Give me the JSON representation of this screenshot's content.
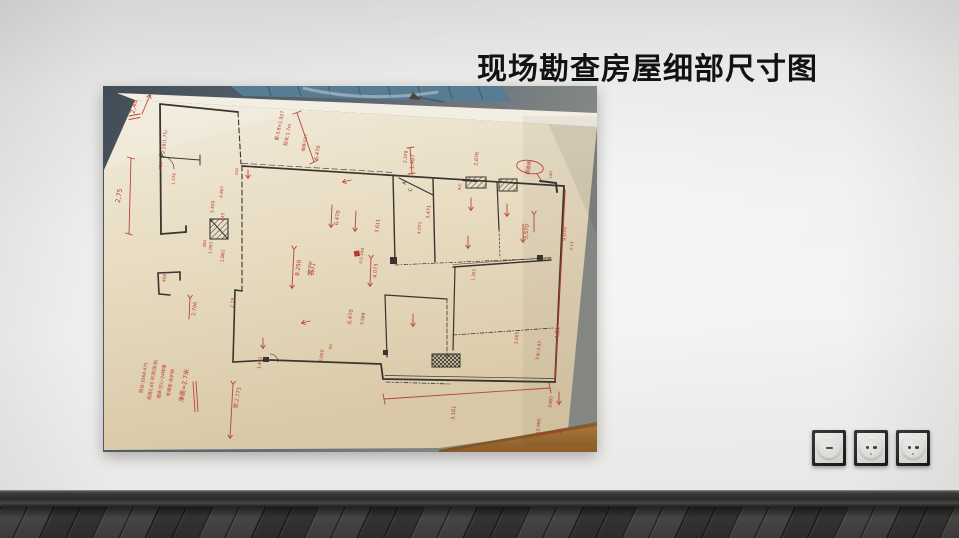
{
  "title": "现场勘查房屋细部尺寸图",
  "colors": {
    "ink_red": "#b23a2b",
    "ink_black": "#332e28",
    "paper": "#e9dfc6",
    "wall": "#ededec",
    "floor": "#3c3b3a",
    "table_blue": "#5a7c92",
    "baseboard": "#2b2b2a"
  },
  "photo": {
    "annotations": {
      "a1": "2,48",
      "a2": "2.18(1.75)",
      "a3": "450",
      "a4": "1.376",
      "a5": "2,75",
      "a6": "3.400",
      "a7": "445",
      "a8": "1.093",
      "a9": "1,861",
      "a10": "400",
      "a11": "2.706",
      "a12": "2,18",
      "a13": "窗:3.8×1.927",
      "a14": "延长:1.7m",
      "a15": "墙高:537",
      "a16": "6.470",
      "a17": "1,487",
      "a18": "2,876",
      "a19": "烟道阀",
      "a20": "6.470",
      "a21": "3.611",
      "a22": "8.250",
      "a23": "客厅",
      "a24": "4.5·240",
      "a25": "4.073",
      "a26": "6.470",
      "a27": "3,588",
      "a28": "3,471",
      "a29": "4.071",
      "a30": "2,378",
      "a31": "3,570",
      "a32": "4.070",
      "a33": "2.13",
      "a34": "1.303",
      "a35": "2.665",
      "a36": "4,81",
      "a37": "下水:3.42",
      "a38": "2465",
      "a39": "2.465",
      "a40": "3,181",
      "a41": "1,401",
      "a42": "3.050",
      "a43": "50",
      "a44": "宽:2.771",
      "a45": "140",
      "a46": "4.897",
      "a47": "318",
      "a48": "300",
      "ac1": "A",
      "ac2": "C",
      "ac3": "A/C",
      "n1": "阳台:3268·475",
      "n2": "层高2.60·吊顶(现浇)",
      "n3": "墙体:空心·24砖墙",
      "n4": "老墙皮·未铲除",
      "n5": "净高=2.7米"
    }
  },
  "outlets": {
    "items": [
      {
        "icon": "dimmer-knob-icon"
      },
      {
        "icon": "euro-socket-icon"
      },
      {
        "icon": "euro-socket-icon"
      }
    ]
  }
}
